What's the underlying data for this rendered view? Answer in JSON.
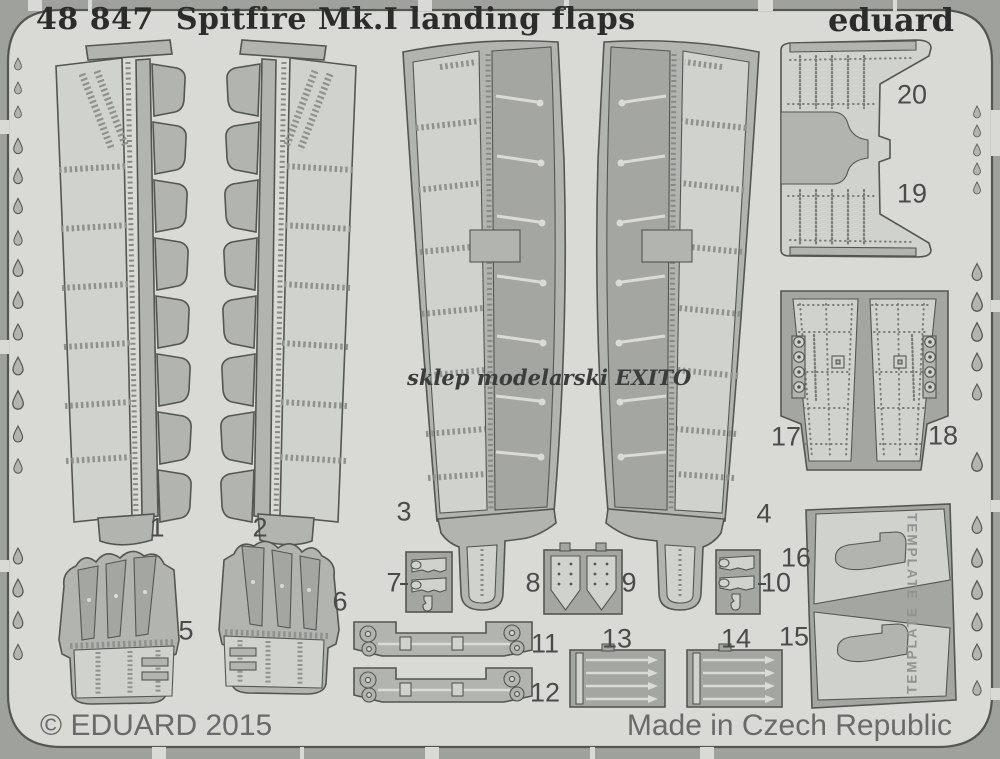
{
  "header": {
    "catalog_number": "48 847",
    "product_title": "Spitfire Mk.I landing flaps",
    "brand": "eduard"
  },
  "watermark": {
    "text": "sklep modelarski EXITO"
  },
  "footer": {
    "copyright": "© EDUARD 2015",
    "origin": "Made in Czech Republic"
  },
  "templates": {
    "label": "TEMPLATE"
  },
  "parts": [
    {
      "number": "1"
    },
    {
      "number": "2"
    },
    {
      "number": "3"
    },
    {
      "number": "4"
    },
    {
      "number": "5"
    },
    {
      "number": "6"
    },
    {
      "number": "7"
    },
    {
      "number": "8"
    },
    {
      "number": "9"
    },
    {
      "number": "10"
    },
    {
      "number": "11"
    },
    {
      "number": "12"
    },
    {
      "number": "13"
    },
    {
      "number": "14"
    },
    {
      "number": "15"
    },
    {
      "number": "16"
    },
    {
      "number": "17"
    },
    {
      "number": "18"
    },
    {
      "number": "19"
    },
    {
      "number": "20"
    }
  ],
  "colors": {
    "background": "#9fa19d",
    "sheet": "#d9dad6",
    "part_light": "#d0d2cd",
    "part_medium": "#b1b4af",
    "part_dark": "#a3a6a1",
    "outline": "#54574f",
    "detail": "#8f928e",
    "strut": "#dadbd7",
    "title_text": "#2b2d2b",
    "footer_text": "#696b69",
    "label_text": "#4a4c4a"
  }
}
